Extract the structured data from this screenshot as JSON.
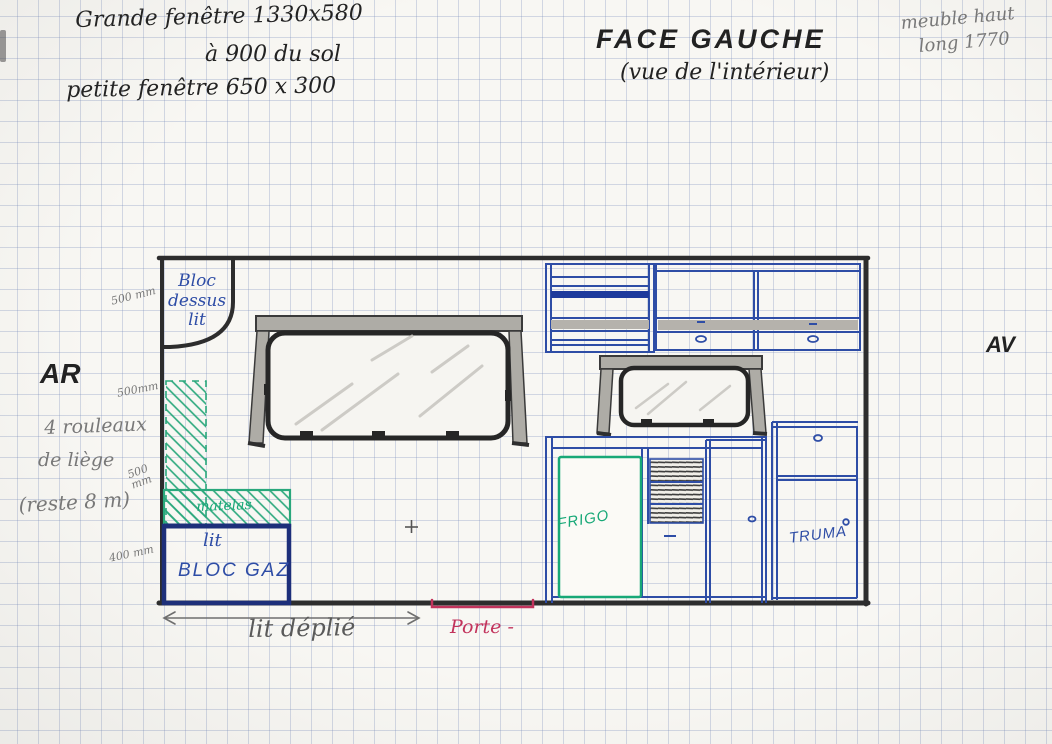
{
  "header": {
    "window_note_line1": "Grande fenêtre 1330x580",
    "window_note_line2": "à 900 du sol",
    "window_note_line3": "petite fenêtre 650 x 300",
    "title": "FACE GAUCHE",
    "subtitle": "(vue de l'intérieur)",
    "cabinet_note_line1": "meuble haut",
    "cabinet_note_line2": "long 1770"
  },
  "orientation": {
    "rear_label": "AR",
    "front_label": "AV"
  },
  "side_annotations": {
    "dim_500_top": "500 mm",
    "dim_500_mid": "500mm",
    "cork_line1": "4 rouleaux",
    "cork_line2": "de liège",
    "dim_500_low": "500\nmm",
    "cork_rest": "(reste 8 m)",
    "dim_400": "400 mm"
  },
  "furniture_labels": {
    "bloc_dessus_lit": "Bloc\ndessus\nlit",
    "matelas": "matelas",
    "lit": "lit",
    "bloc_gaz": "BLOC GAZ",
    "frigo": "FRIGO",
    "truma": "TRUMA"
  },
  "bottom_annotations": {
    "lit_deplie": "lit déplié",
    "porte": "Porte -"
  },
  "colors": {
    "ink_blue": "#2e4da6",
    "ink_green": "#17a877",
    "ink_red": "#c2335c",
    "ink_black": "#222222",
    "pencil_gray": "#787878",
    "wall_dark": "#2d2d2d"
  }
}
